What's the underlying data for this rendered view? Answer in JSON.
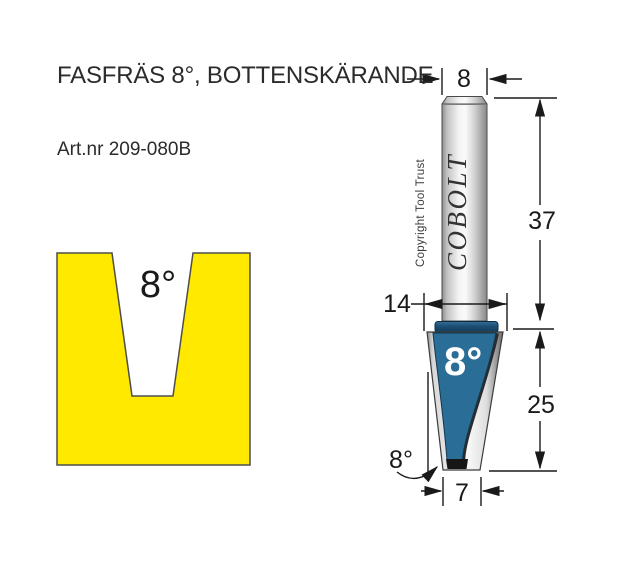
{
  "title": "FASFRÄS 8°, BOTTENSKÄRANDE",
  "art_nr": "Art.nr 209-080B",
  "profile": {
    "angle_label": "8°",
    "fill": "#ffe900",
    "outline": "#4d4d4d"
  },
  "bit": {
    "brand": "COBOLT",
    "copyright_note": "Copyright Tool Trust",
    "cutter_face_label": "8°",
    "colors": {
      "cutter_blue": "#2a6d96",
      "collar_blue": "#1d5076",
      "line": "#1a1a1a"
    },
    "dims": {
      "shank_diameter_mm": "8",
      "shank_length_mm": "37",
      "cutter_top_width_mm": "14",
      "cutter_length_mm": "25",
      "tip_width_mm": "7",
      "bevel_angle": "8°"
    }
  }
}
